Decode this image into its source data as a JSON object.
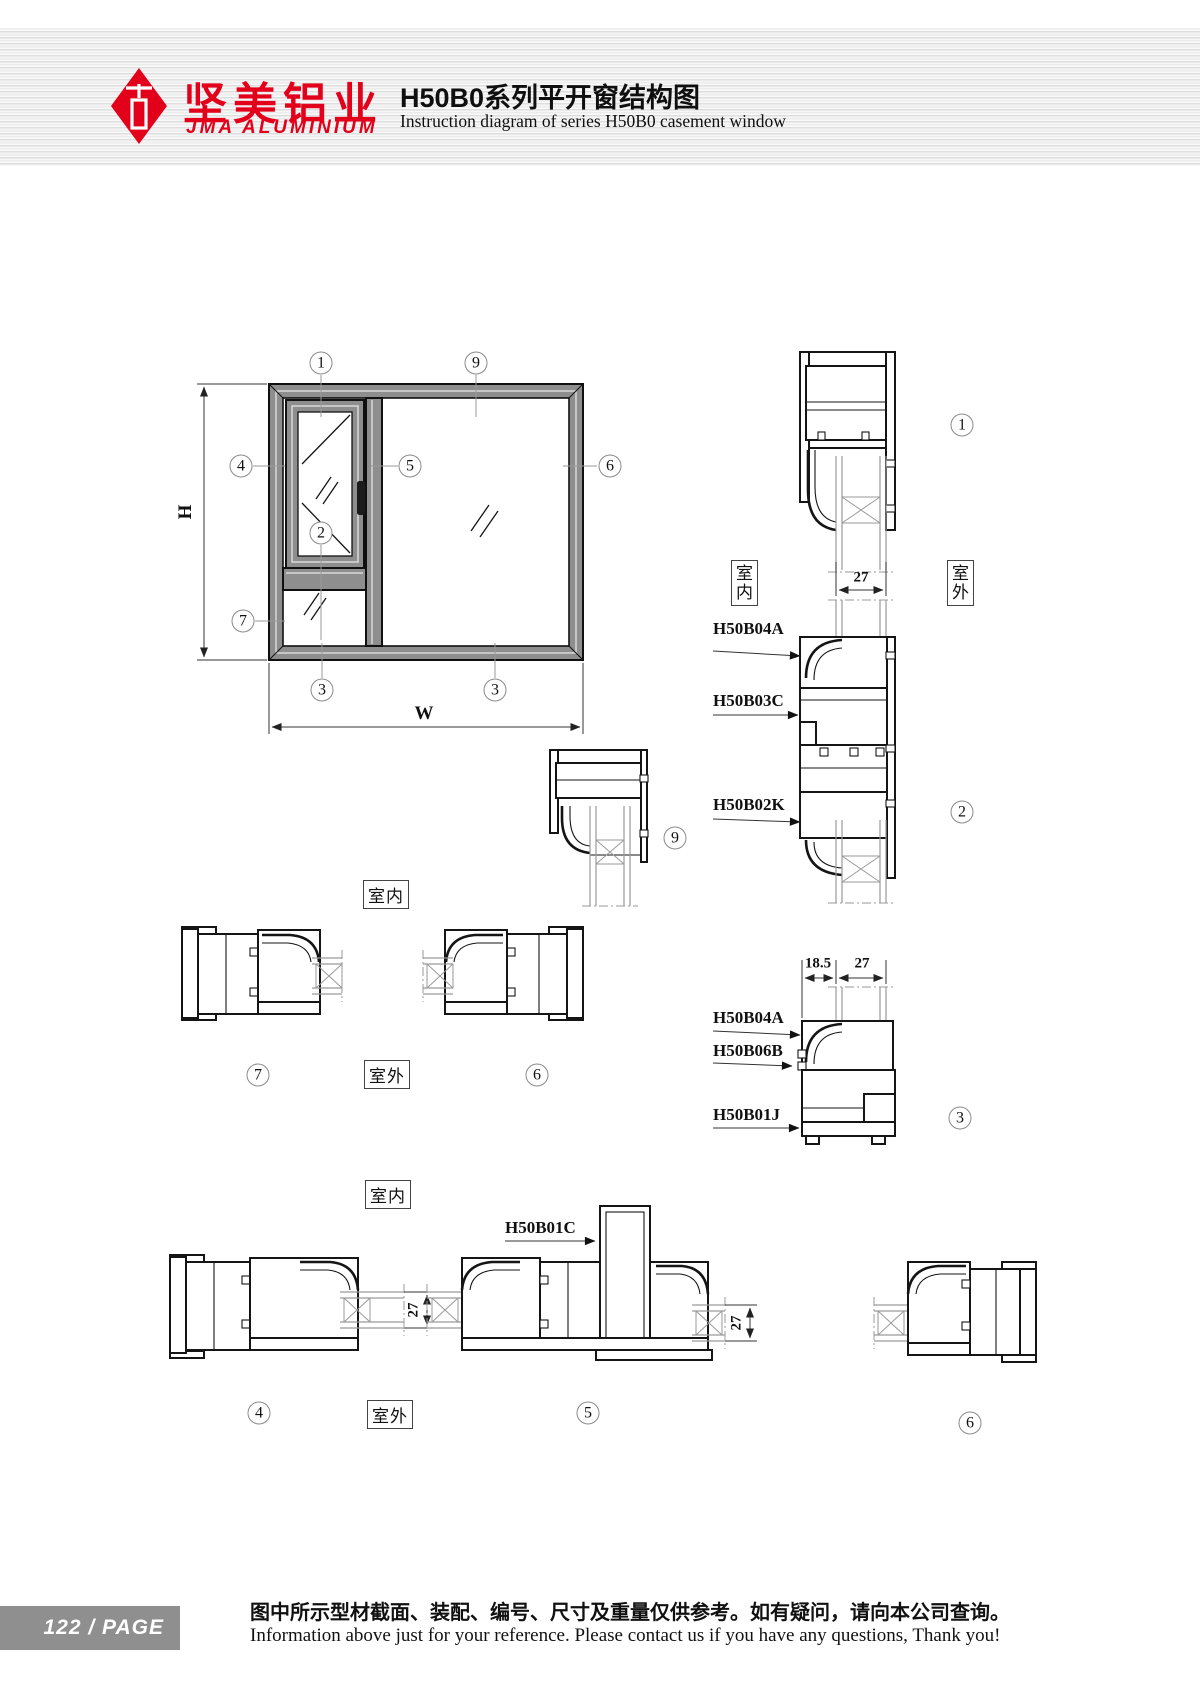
{
  "header": {
    "brand_cn": "坚美铝业",
    "brand_en": "JMA ALUMINIUM",
    "title_cn": "H50B0系列平开窗结构图",
    "title_en": "Instruction diagram of series H50B0 casement window"
  },
  "side_labels": {
    "indoor": "室内",
    "outdoor": "室外"
  },
  "dims": {
    "h": "H",
    "w": "W",
    "d27": "27",
    "d185": "18.5"
  },
  "parts": {
    "p04a": "H50B04A",
    "p03c": "H50B03C",
    "p02k": "H50B02K",
    "p06b": "H50B06B",
    "p01j": "H50B01J",
    "p01c": "H50B01C"
  },
  "callouts": {
    "n1": "1",
    "n2": "2",
    "n3": "3",
    "n4": "4",
    "n5": "5",
    "n6": "6",
    "n7": "7",
    "n9": "9"
  },
  "footer": {
    "page_badge": "122 / PAGE",
    "note_cn": "图中所示型材截面、装配、编号、尺寸及重量仅供参考。如有疑问，请向本公司查询。",
    "note_en": "Information above just for your reference. Please contact us if you have any questions, Thank you!"
  },
  "colors": {
    "brand_red": "#e2001a",
    "frame_gray": "#8e8e8e",
    "badge_gray": "#8f8f8f"
  }
}
